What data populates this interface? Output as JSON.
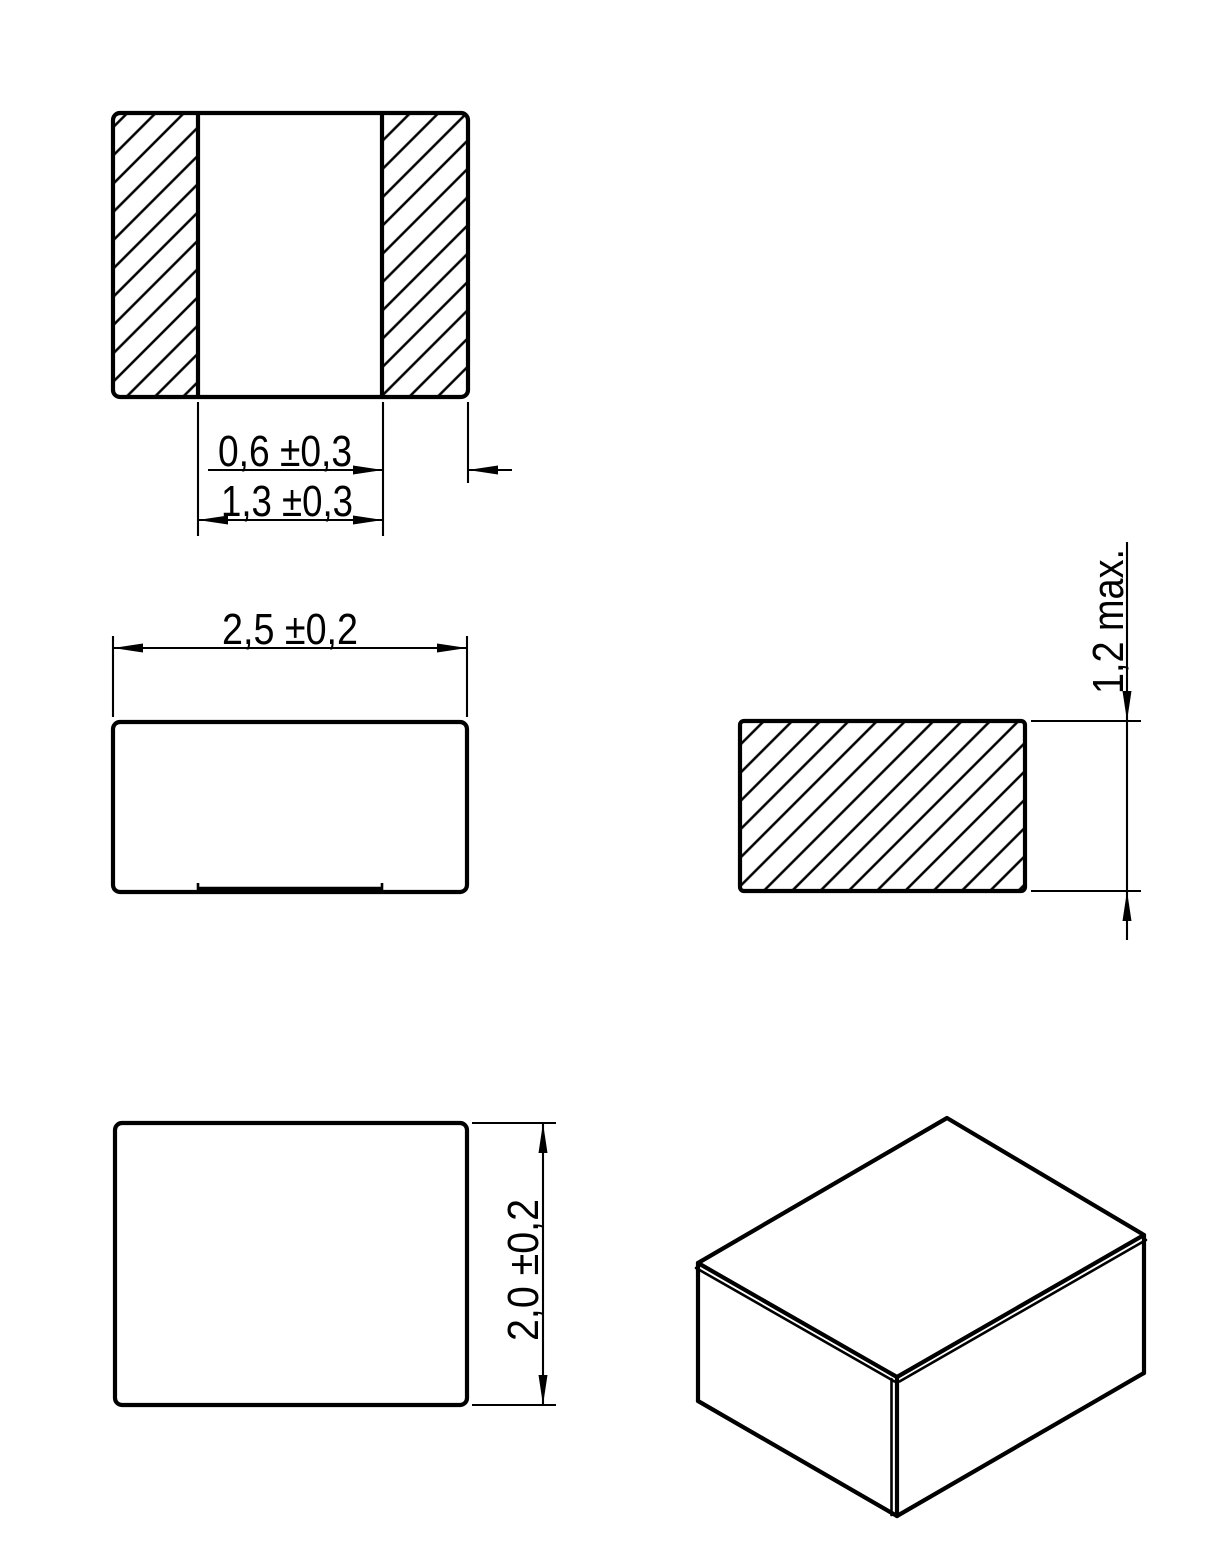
{
  "drawing": {
    "background_color": "#ffffff",
    "line_color": "#000000",
    "dimension_labels": {
      "termination_width": "0,6 ±0,3",
      "termination_gap": "1,3 ±0,3",
      "body_length": "2,5 ±0,2",
      "body_thickness_max": "1,2 max.",
      "body_width": "2,0 ±0,2"
    }
  }
}
